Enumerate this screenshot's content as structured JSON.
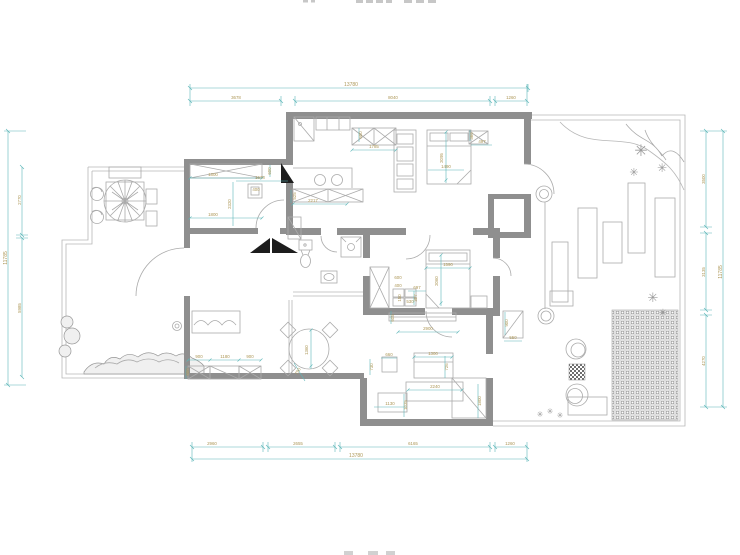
{
  "colors": {
    "wall": "#8f8f8f",
    "thin_line": "#b6b6b6",
    "dim_line": "#5db6b8",
    "dim_text": "#ad9757",
    "arrow": "#1d1d1d",
    "background": "#ffffff"
  },
  "icons": {
    "plant": "✳"
  },
  "dims": {
    "top": {
      "total": "13780",
      "segments": [
        "3678",
        "8040",
        "1260"
      ]
    },
    "bottom": {
      "total": "13780",
      "segments": [
        "2960",
        "2655",
        "6165",
        "1260"
      ]
    },
    "left": {
      "total": "11785",
      "segments": [
        "2770",
        "5985"
      ]
    },
    "right": {
      "total": "11785",
      "segments": [
        "3500",
        "3135",
        "4270"
      ]
    },
    "interior": [
      "1800",
      "1678",
      "600",
      "2320",
      "400",
      "1800",
      "2217",
      "525",
      "600",
      "1785",
      "2095",
      "1490",
      "366",
      "497",
      "900",
      "1180",
      "900",
      "600",
      "1360",
      "790",
      "1590",
      "2060",
      "400",
      "600",
      "697",
      "307",
      "150",
      "530",
      "605",
      "2900",
      "660",
      "730",
      "1300",
      "726",
      "2240",
      "1800",
      "1130",
      "1035",
      "900",
      "550"
    ]
  }
}
